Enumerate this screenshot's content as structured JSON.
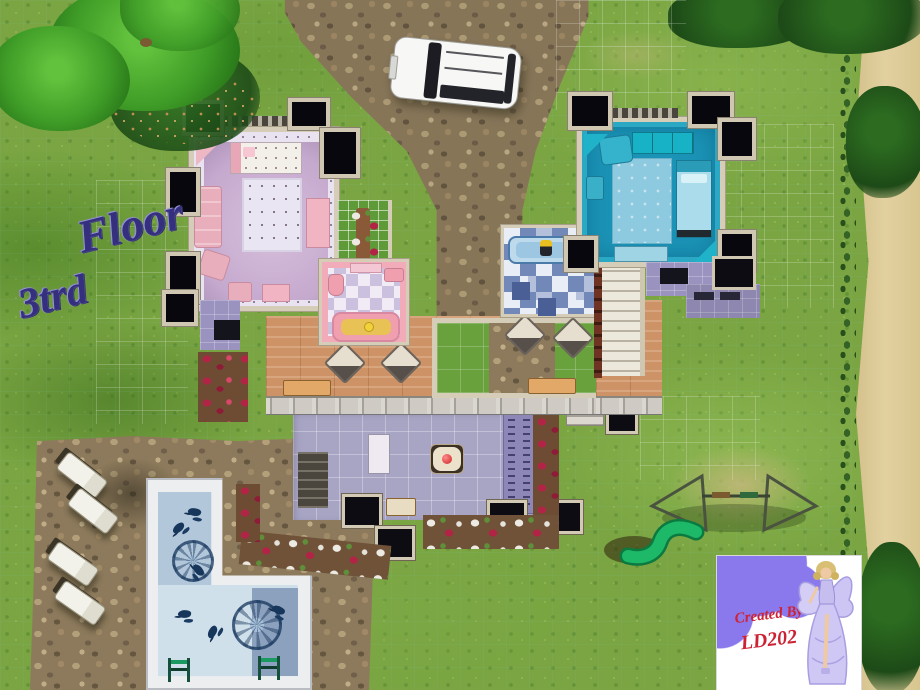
{
  "floor_label": {
    "word1": "3trd",
    "word2": "Floor"
  },
  "watermark": {
    "line1": "Created By",
    "line2": "LD202"
  },
  "palette": {
    "grass": "#7aa542",
    "stone": "#8d7a5c",
    "wall": "#d5cdb8",
    "purple_room": "#c5a9ce",
    "blue_room": "#1b93b6",
    "pink_bath": "#f2abb9",
    "deck_wood": "#cd9266",
    "patio_tile": "#a8a4c4",
    "pool_water": "#b6c9dc",
    "flower_red": "#b5264a",
    "wm_purple": "#8a79ec",
    "wm_text": "#cc2233",
    "label_ink": "#35307e"
  }
}
